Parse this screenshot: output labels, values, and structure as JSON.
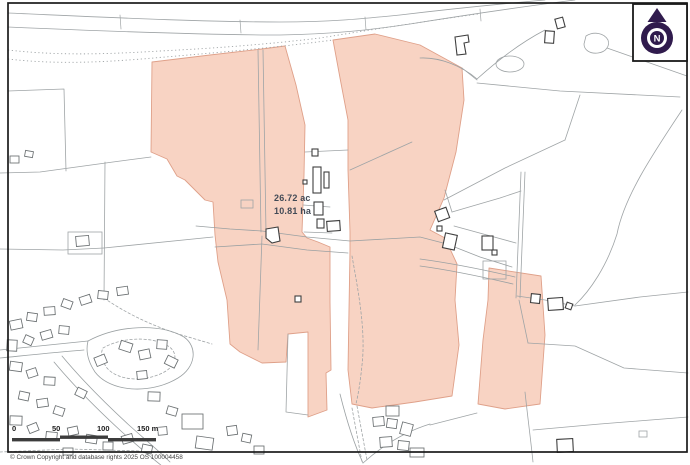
{
  "map": {
    "title": "ordnance-survey-site-plan",
    "area_label": {
      "line1": "26.72 ac",
      "line2": "10.81 ha"
    },
    "compass": {
      "letter": "N"
    },
    "scale_bar": {
      "ticks": [
        "0",
        "50",
        "100",
        "150 m"
      ]
    },
    "copyright": "© Crown Copyright and database rights 2025 OS 100004458"
  },
  "colors": {
    "parcel_fill": "#f8d3c3",
    "parcel_edge": "#dfa089",
    "line_gray": "#9fa4a6",
    "road_gray": "#9aa0a2",
    "house_gray": "#6a6f71",
    "building_dark": "#3f3f3f",
    "compass_navy": "#301b4d",
    "label_color": "#424a56",
    "scale_bar_color": "#3c3c3c",
    "frame_black": "#1a1a1a",
    "copyright_color": "#444444"
  }
}
